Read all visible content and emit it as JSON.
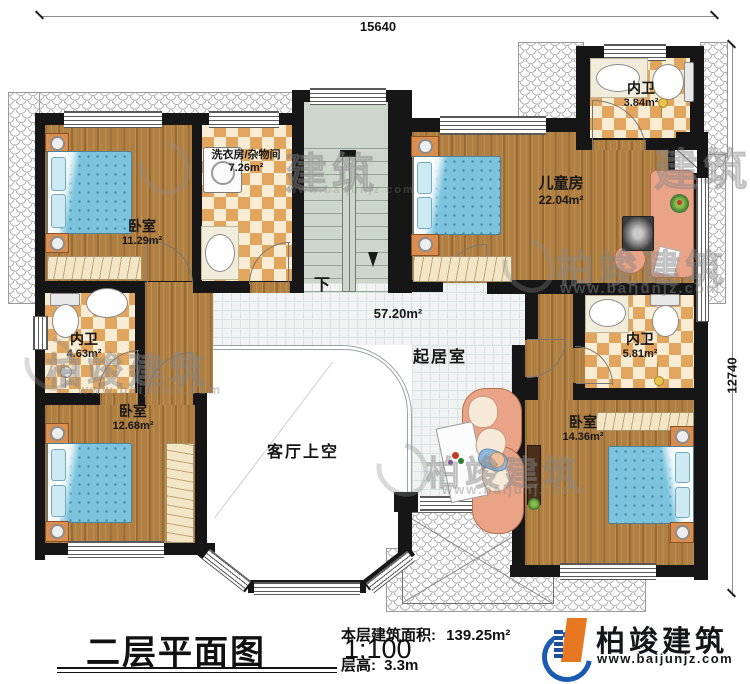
{
  "colors": {
    "wall": "#161616",
    "wood_floor": "#b07f42",
    "checker_tan": "#e2a55e",
    "checker_cream": "#f8ecd4",
    "tile_floor": "#f0f3f1",
    "stair_floor": "#cdd6cb",
    "bed_blue": "#7cc4dd",
    "furniture_salmon": "#e9a387",
    "nightstand_orange": "#d98e4f",
    "logo_blue": "#1c5cb0",
    "logo_orange": "#e87722",
    "ink": "#111111"
  },
  "dimensions": {
    "top": "15640",
    "right": "12740"
  },
  "rooms": {
    "bedroom_tl": {
      "name": "卧室",
      "area": "11.29m²"
    },
    "laundry": {
      "name": "洗衣房/杂物间",
      "area": "7.26m²"
    },
    "bath_top": {
      "name": "内卫",
      "area": "3.84m²"
    },
    "kids": {
      "name": "儿童房",
      "area": "22.04m²"
    },
    "bath_left": {
      "name": "内卫",
      "area": "4.63m²"
    },
    "bath_right": {
      "name": "内卫",
      "area": "5.81m²"
    },
    "bedroom_bl": {
      "name": "卧室",
      "area": "12.68m²"
    },
    "bedroom_br": {
      "name": "卧室",
      "area": "14.36m²"
    },
    "living": {
      "name": "起居室",
      "area": "57.20m²"
    },
    "void": {
      "name": "客厅上空"
    }
  },
  "stairs": {
    "down": "下"
  },
  "titleblock": {
    "title": "二层平面图",
    "scale": "1:100",
    "area_label": "本层建筑面积:",
    "area_value": "139.25m²",
    "height_label": "层高:",
    "height_value": "3.3m"
  },
  "branding": {
    "name": "柏竣建筑",
    "url": "www.baijunjz.com"
  },
  "watermark": {
    "name": "柏竣建筑",
    "short": "建筑",
    "url": "www.baijunjz.com"
  }
}
